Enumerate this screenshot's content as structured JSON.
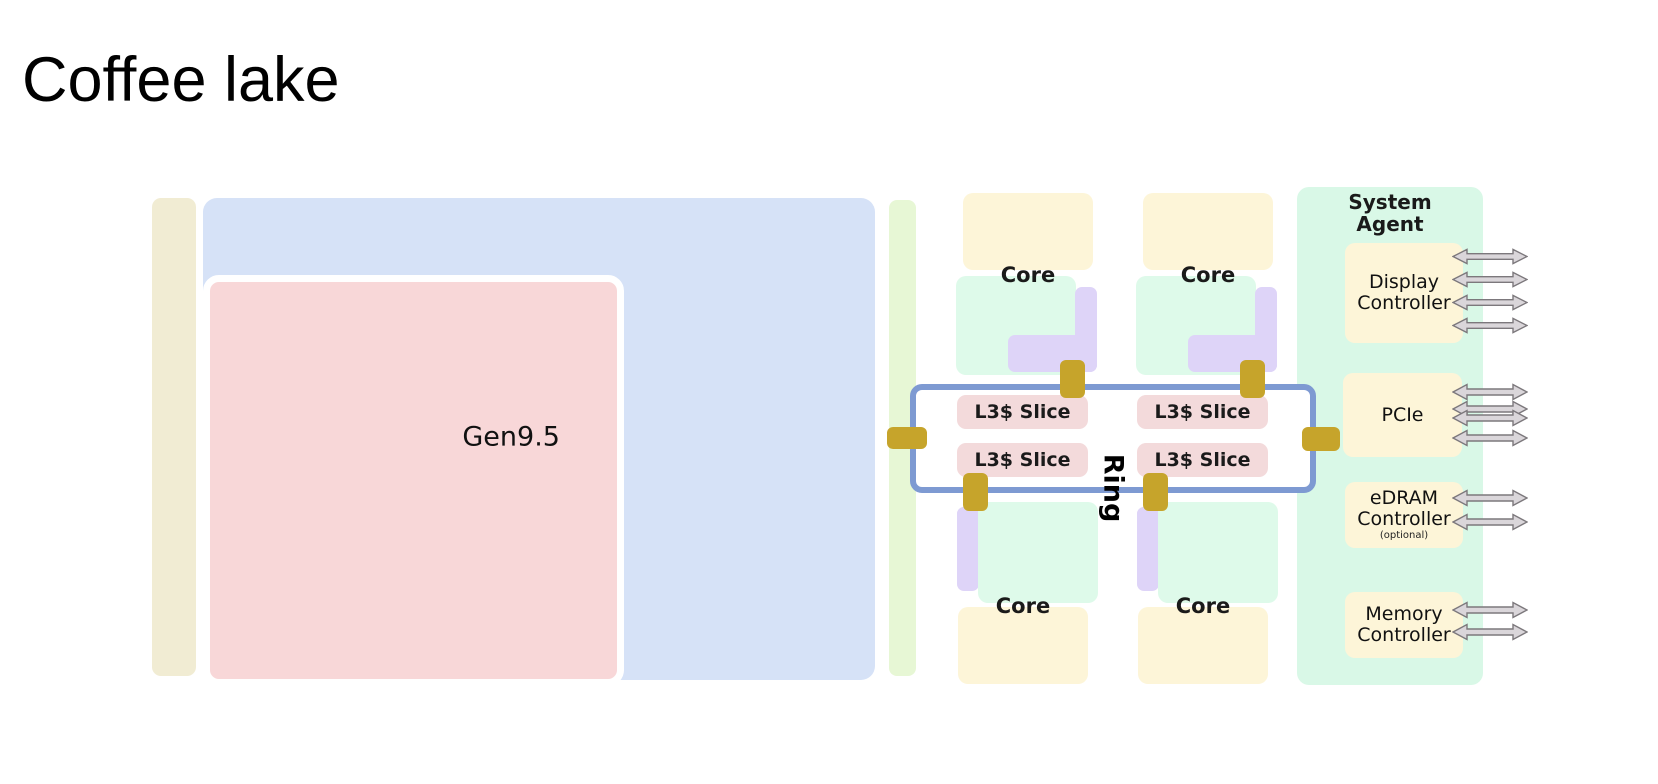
{
  "title": "Coffee lake",
  "labels": {
    "gpu": "Gen9.5",
    "core": "Core",
    "l3_slice": "L3$ Slice",
    "ring": "Ring"
  },
  "system_agent": {
    "title_line1": "System",
    "title_line2": "Agent",
    "display_controller": {
      "line1": "Display",
      "line2": "Controller",
      "arrows": 4
    },
    "pcie": {
      "label": "PCIe",
      "arrows": 4
    },
    "edram_controller": {
      "line1": "eDRAM",
      "line2": "Controller",
      "note": "(optional)",
      "arrows": 2
    },
    "memory_controller": {
      "line1": "Memory",
      "line2": "Controller",
      "arrows": 2
    }
  },
  "icons": {
    "bus_arrow": "double-headed-horizontal-arrow"
  },
  "colors": {
    "strip-beige": "#f1ecd3",
    "block-blue": "#d6e2f7",
    "block-pink": "#f8d7d8",
    "strip-green": "#e7f7d5",
    "core-cream": "#fdf5d8",
    "core-mint": "#defaea",
    "core-purple": "#ded4f8",
    "l3-pink": "#f3dadb",
    "gold": "#c6a42b",
    "ring-blue": "#7e9ad2",
    "sa-mint": "#d9f8e7",
    "arrow-fill": "#dad6da",
    "arrow-stroke": "#7c787c"
  }
}
